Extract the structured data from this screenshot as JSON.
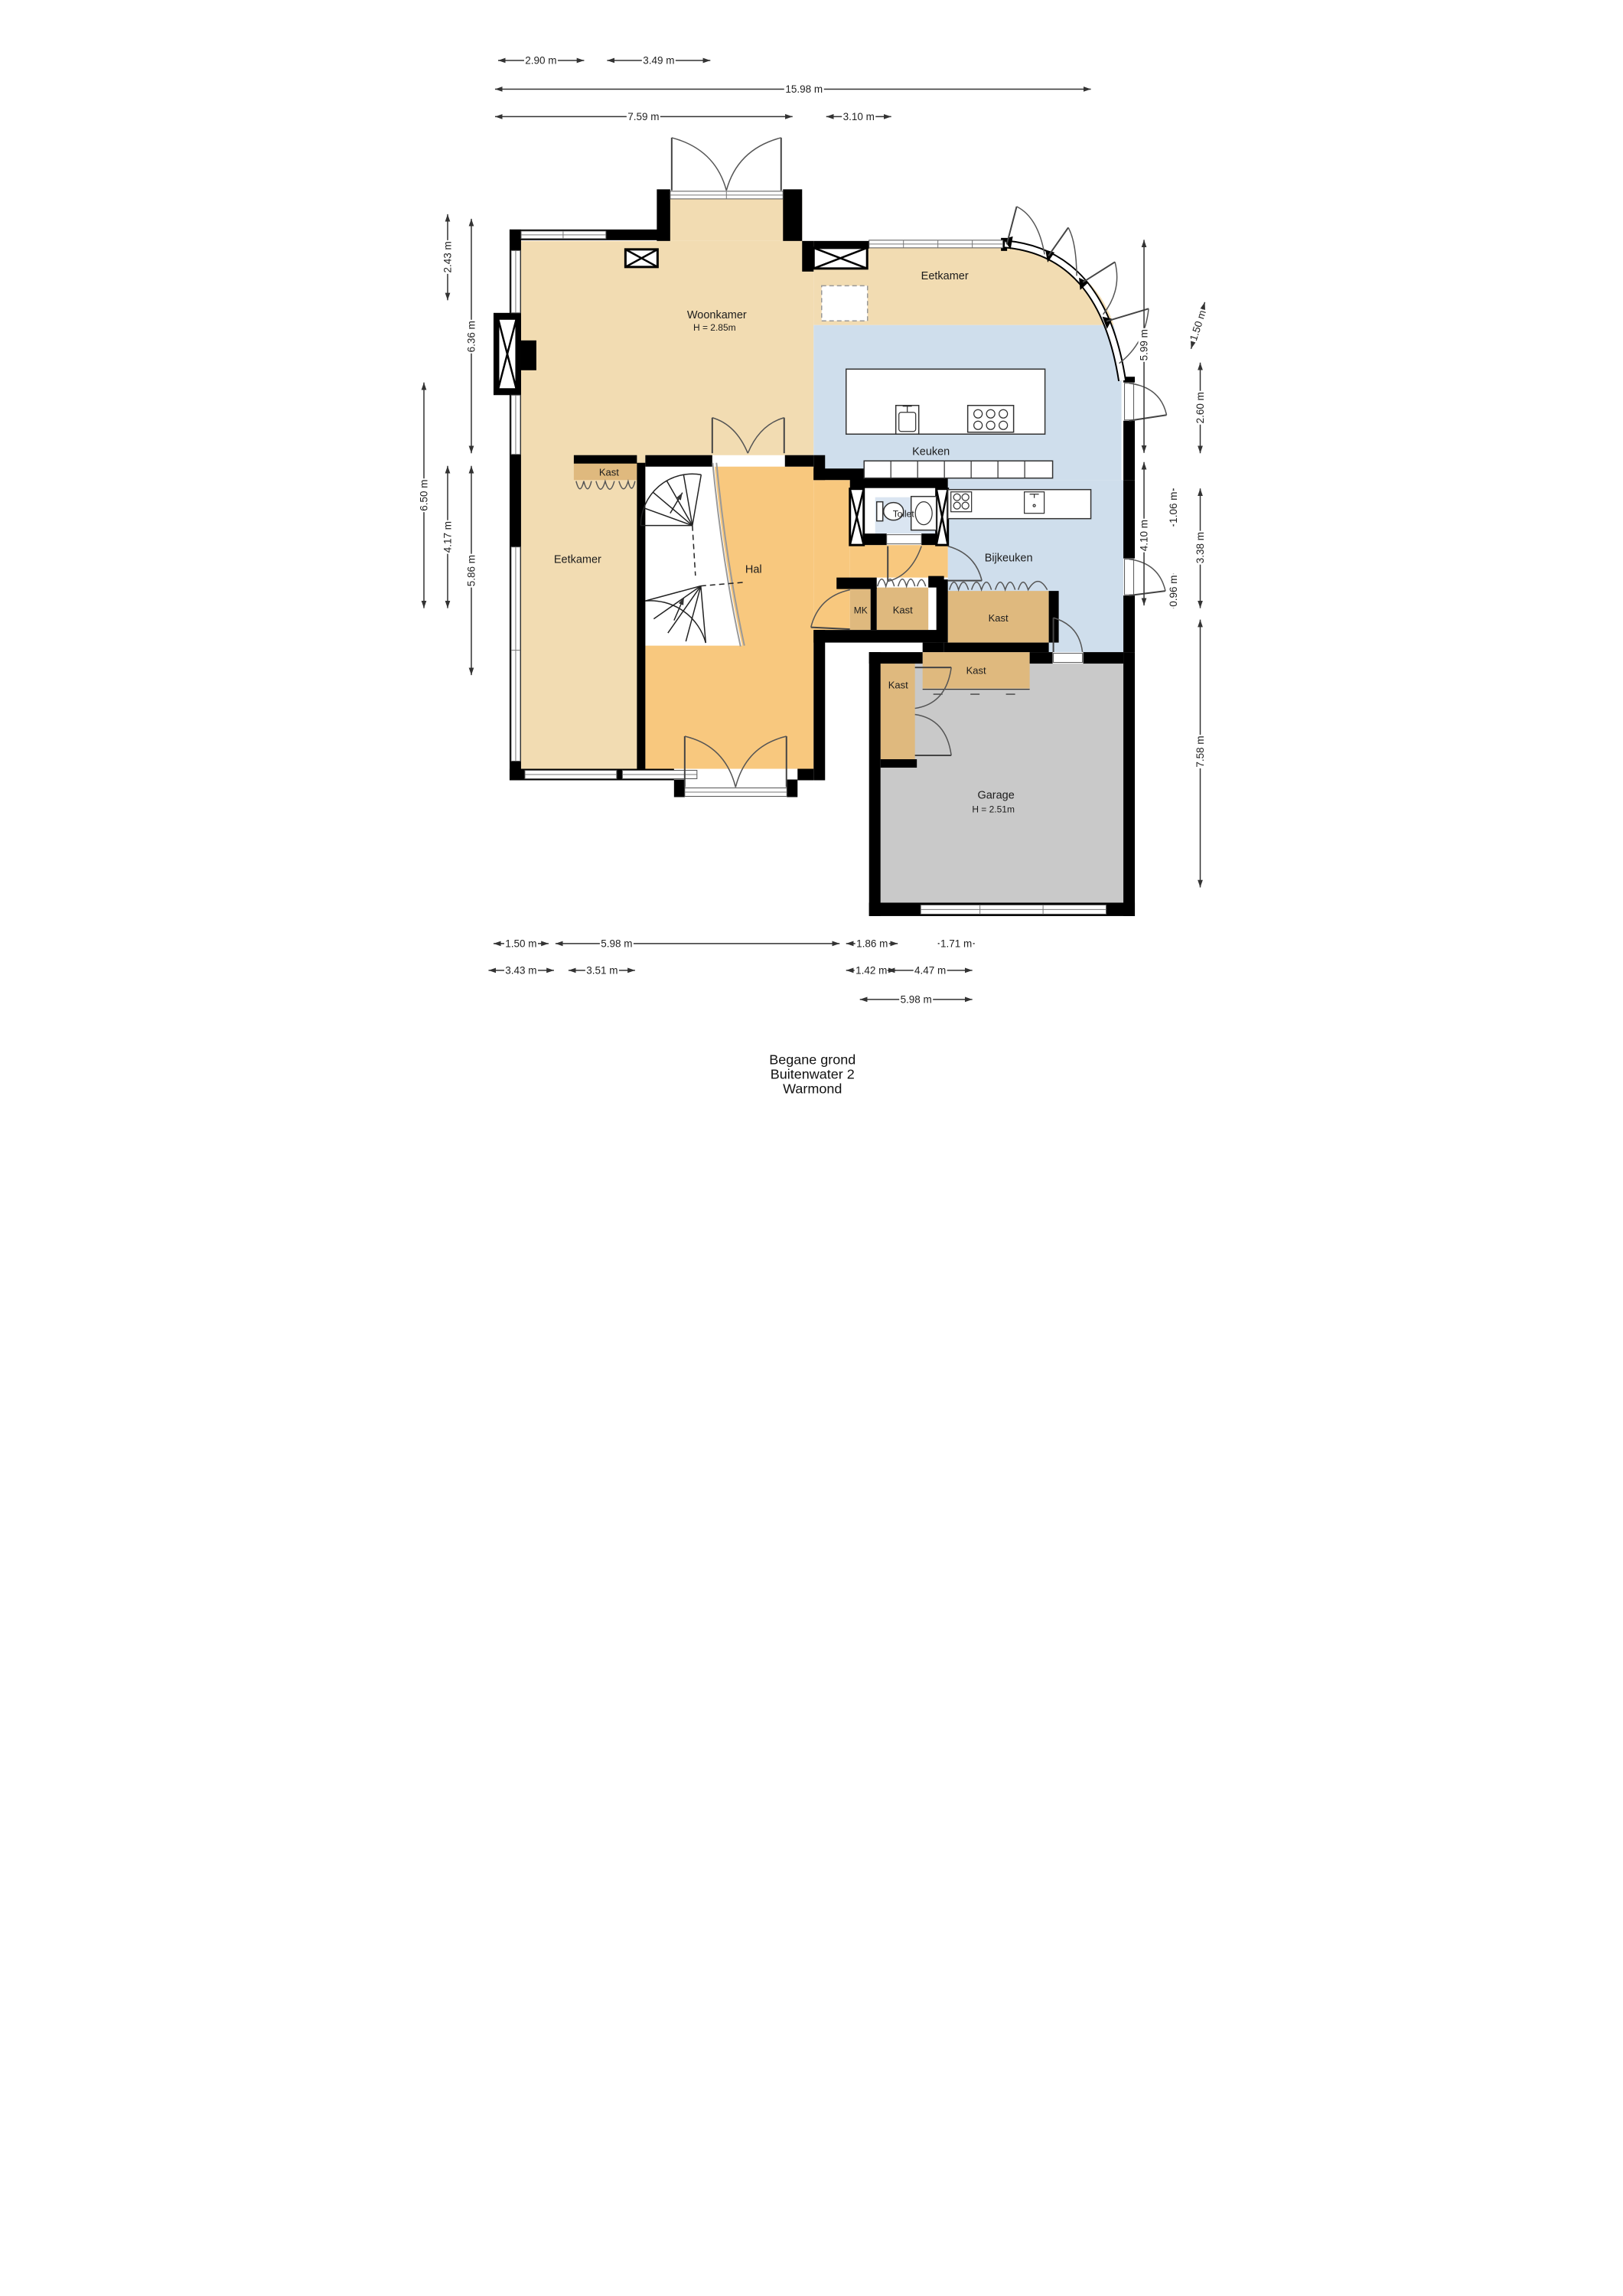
{
  "title": {
    "floor": "Begane grond",
    "street": "Buitenwater 2",
    "city": "Warmond"
  },
  "rooms": {
    "woonkamer": {
      "label": "Woonkamer",
      "height": "H = 2.85m"
    },
    "eetkamer_top": {
      "label": "Eetkamer"
    },
    "keuken": {
      "label": "Keuken"
    },
    "eetkamer_left": {
      "label": "Eetkamer"
    },
    "hal": {
      "label": "Hal"
    },
    "toilet": {
      "label": "Toilet"
    },
    "bijkeuken": {
      "label": "Bijkeuken"
    },
    "mk": {
      "label": "MK"
    },
    "kast_eetkamer": {
      "label": "Kast"
    },
    "kast_hal": {
      "label": "Kast"
    },
    "kast_bijkeuken": {
      "label": "Kast"
    },
    "kast_garage_top": {
      "label": "Kast"
    },
    "kast_garage_left": {
      "label": "Kast"
    },
    "garage": {
      "label": "Garage",
      "height": "H = 2.51m"
    }
  },
  "dimensions": {
    "top": [
      "2.90 m",
      "3.49 m",
      "15.98 m",
      "7.59 m",
      "3.10 m"
    ],
    "left": [
      "2.43 m",
      "6.36 m",
      "6.50 m",
      "4.17 m",
      "5.86 m"
    ],
    "right": [
      "1.50 m",
      "5.99 m",
      "2.60 m",
      "1.06 m",
      "4.10 m",
      "0.96 m",
      "3.38 m",
      "7.58 m"
    ],
    "bottom": [
      "1.50 m",
      "5.98 m",
      "1.86 m",
      "1.71 m",
      "3.43 m",
      "3.51 m",
      "1.42 m",
      "4.47 m",
      "5.98 m"
    ]
  },
  "colors": {
    "living": "#f2dcb2",
    "hal": "#f8c87e",
    "kast": "#dfb97e",
    "water": "#cfdeec",
    "toilet": "#dae5f1",
    "garage": "#c9c9c9",
    "wall": "#000000",
    "dim": "#333333"
  }
}
